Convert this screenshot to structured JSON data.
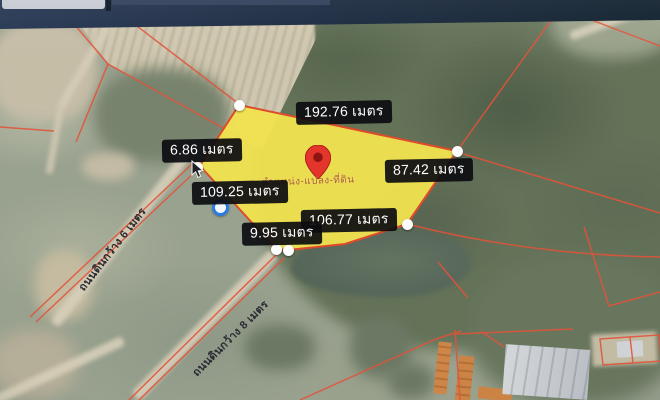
{
  "screen": {
    "type": "photo-of-monitor-showing-satellite-map"
  },
  "colors": {
    "plot_fill": "#f1e34f",
    "plot_border": "#dd4a2c",
    "parcel_lines": "#e2533a",
    "label_bg": "#0c0c10",
    "label_text": "#ffffff",
    "pin": "#e3352b",
    "point_ring": "#2b7ce2",
    "top_bar": "#1c2b45"
  },
  "map": {
    "measurement_labels": [
      {
        "id": "top-edge",
        "text": "192.76 เมตร"
      },
      {
        "id": "left-edge",
        "text": "6.86 เมตร"
      },
      {
        "id": "right-edge",
        "text": "87.42 เมตร"
      },
      {
        "id": "lower-left-edge",
        "text": "109.25 เมตร"
      },
      {
        "id": "bottom-edge",
        "text": "106.77 เมตร"
      },
      {
        "id": "bottom-small-edge",
        "text": "9.95 เมตร"
      }
    ],
    "road_labels": [
      {
        "id": "west-road",
        "text": "ถนนดินกว้าง 6 เมตร"
      },
      {
        "id": "south-road",
        "text": "ถนนดินกว้าง 8 เมตร"
      }
    ],
    "plot_watermark": "ตำแหน่ง-แปลง-ที่ดิน"
  }
}
